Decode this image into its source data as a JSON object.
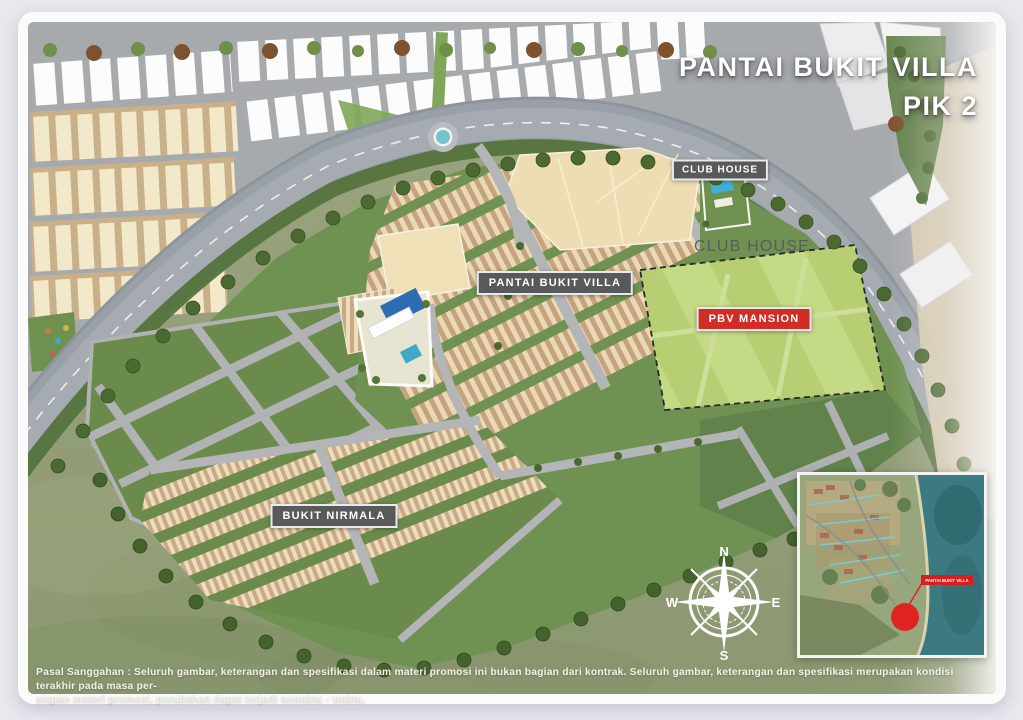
{
  "header": {
    "title_line1": "PANTAI BUKIT VILLA",
    "title_line2": "PIK 2"
  },
  "map_labels": {
    "club_house_badge": "CLUB HOUSE",
    "club_house_area_text": "CLUB HOUSE",
    "pantai_bukit_villa_badge": "PANTAI BUKIT VILLA",
    "pbv_mansion_badge": "PBV MANSION",
    "bukit_nirmala_badge": "BUKIT NIRMALA"
  },
  "compass": {
    "north": "N",
    "south": "S",
    "east": "E",
    "west": "W"
  },
  "inset_map": {
    "marker_label": "PANTAI BUKIT VILLA"
  },
  "disclaimer": {
    "line1": "Pasal Sanggahan : Seluruh gambar, keterangan dan spesifikasi dalam materi promosi ini bukan bagian dari kontrak. Seluruh gambar, keterangan dan spesifikasi merupakan kondisi terakhir pada masa per-",
    "line2": "siapan materi promosi, perubahan dapat terjadi sewaktu - waktu."
  },
  "colors": {
    "badge_gray": "#58595b",
    "badge_red": "#cf2d26",
    "development_green": "#6f9152",
    "housing_tan": "#ead9b4",
    "mansion_green": "#b7cf72",
    "grass_olive": "#95a07b",
    "road_gray": "#9aa0a8",
    "pool_blue": "#2d6cb2",
    "sea_teal": "#3a7a80",
    "marker_red": "#e21d1d"
  }
}
